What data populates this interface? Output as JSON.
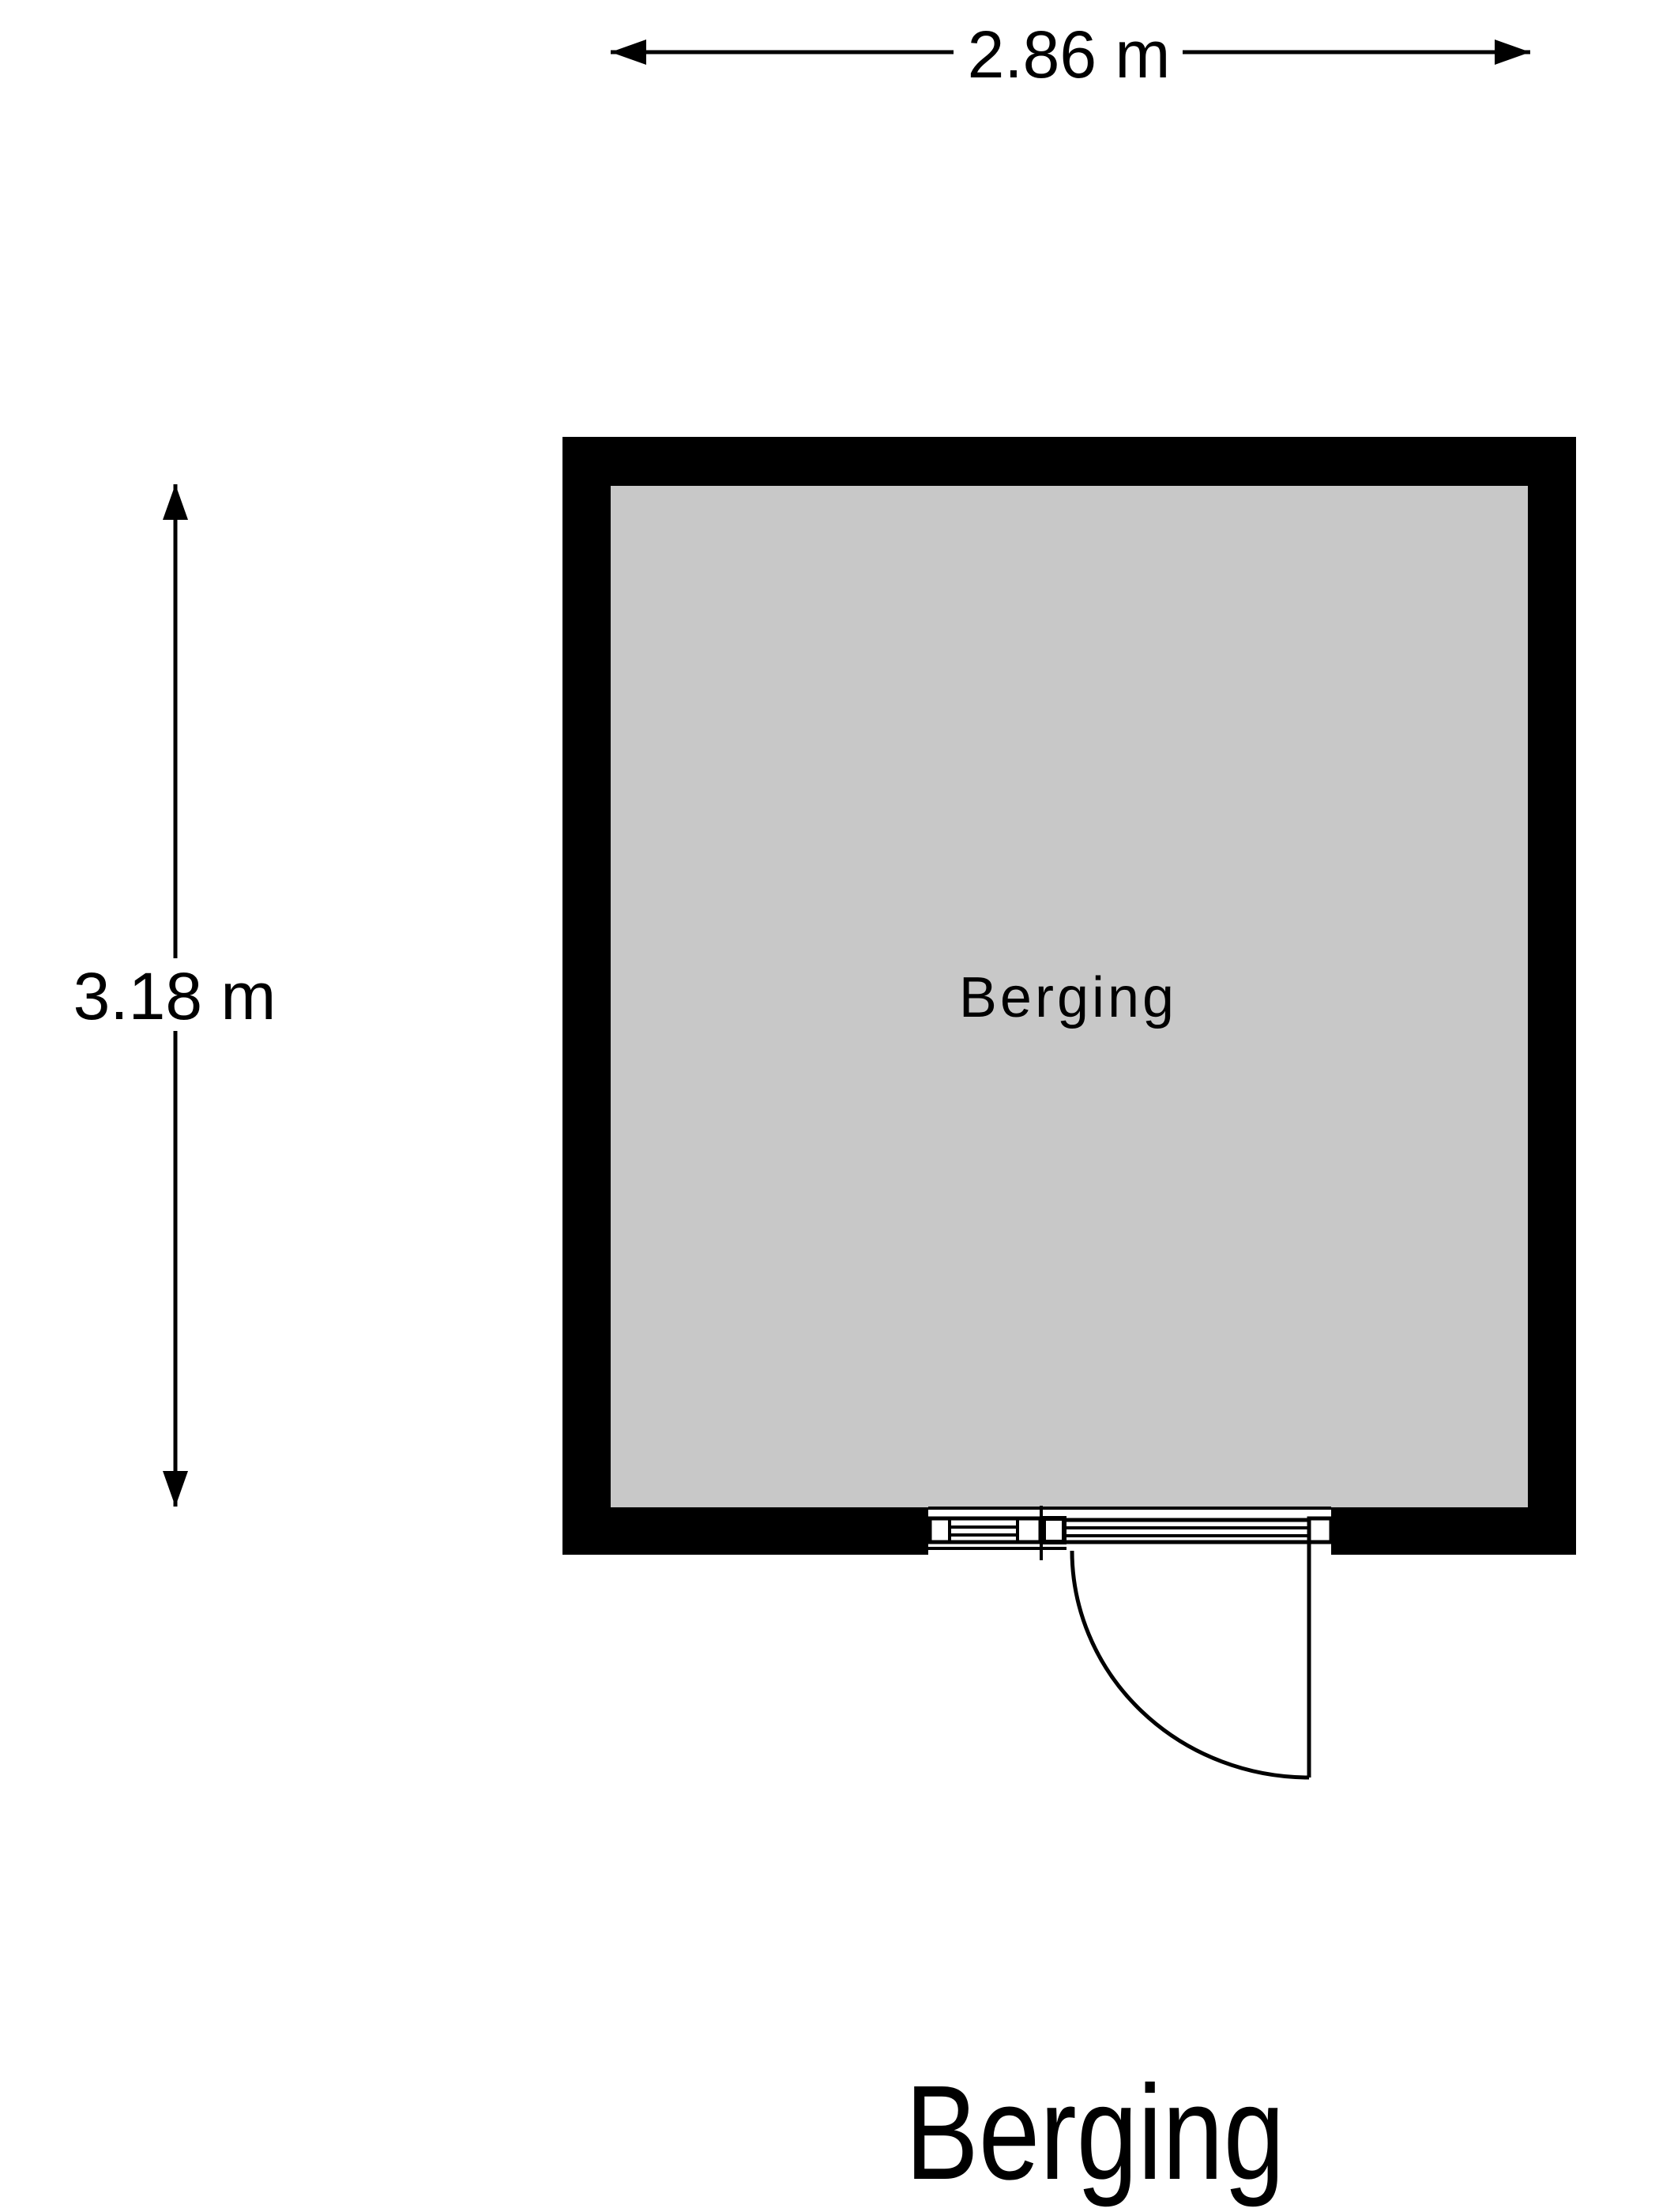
{
  "floorplan": {
    "title": "Berging",
    "room": {
      "name": "Berging"
    },
    "dimensions": {
      "width_label": "2.86 m",
      "height_label": "3.18 m"
    },
    "colors": {
      "wall": "#000000",
      "floor": "#c8c8c8",
      "line": "#000000",
      "background": "#ffffff"
    }
  }
}
